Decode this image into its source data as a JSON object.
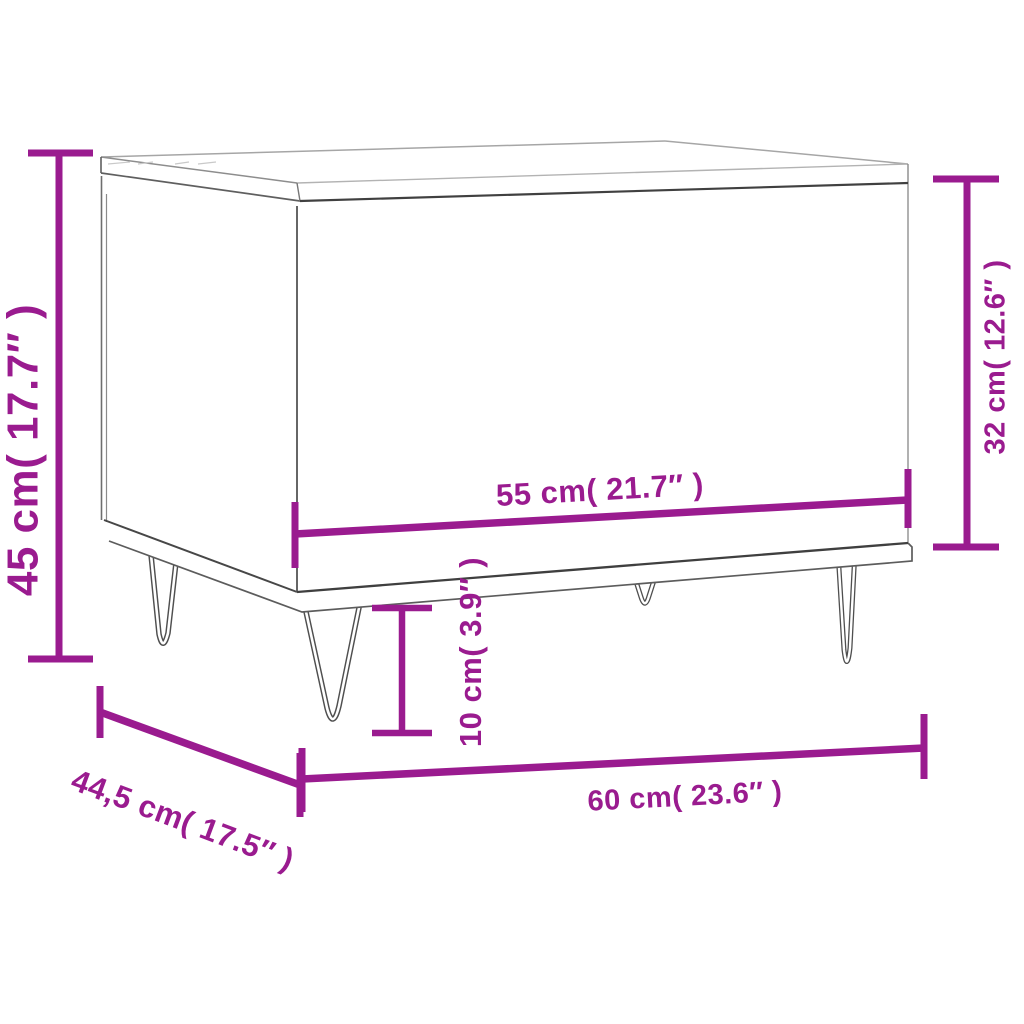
{
  "diagram": {
    "title": "Coffee table dimension diagram",
    "accent_color": "#9A1B8F",
    "line_color": "#4a4a4a",
    "background_color": "#ffffff"
  },
  "dims": {
    "height": {
      "label": "45 cm( 17.7″ )",
      "cm": "45",
      "inches": "17.7"
    },
    "side_height": {
      "label": "32 cm( 12.6″ )",
      "cm": "32",
      "inches": "12.6"
    },
    "top_span": {
      "label": "55 cm( 21.7″ )",
      "cm": "55",
      "inches": "21.7"
    },
    "leg_height": {
      "label": "10 cm( 3.9″ )",
      "cm": "10",
      "inches": "3.9"
    },
    "width": {
      "label": "60 cm( 23.6″ )",
      "cm": "60",
      "inches": "23.6"
    },
    "depth": {
      "label": "44,5 cm( 17.5″ )",
      "cm": "44,5",
      "inches": "17.5"
    }
  }
}
